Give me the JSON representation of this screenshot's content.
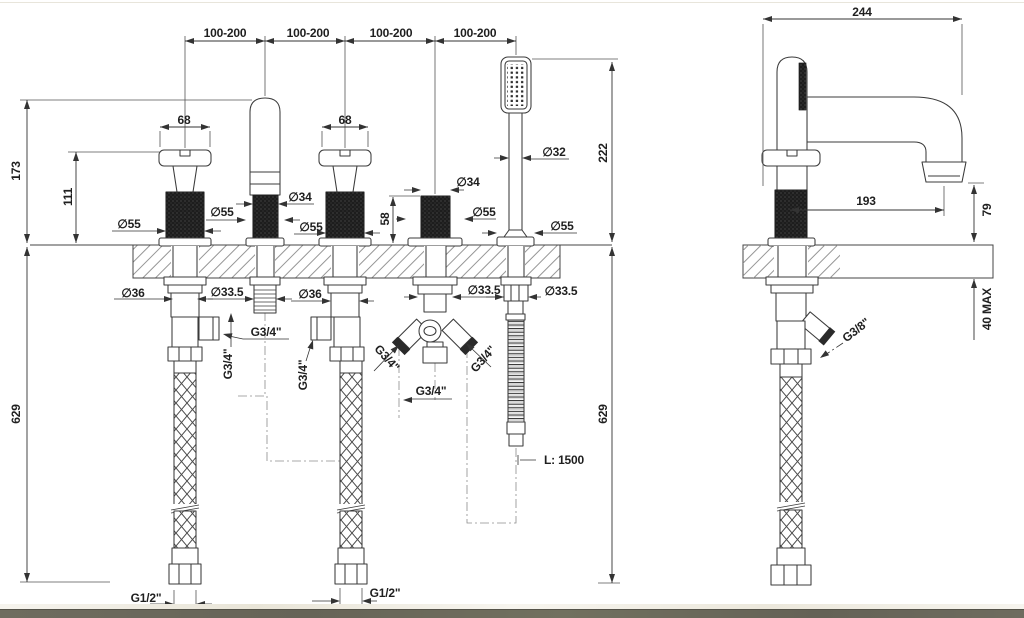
{
  "front_view": {
    "spacing_dims": [
      "100-200",
      "100-200",
      "100-200",
      "100-200"
    ],
    "handle_width_dims": [
      "68",
      "68"
    ],
    "height_dims": {
      "total": "173",
      "handle": "111",
      "knurl": "58",
      "handshower": "222"
    },
    "below_deck_dims": {
      "left": "629",
      "right": "629"
    },
    "diameter_dims": {
      "handle1_knurl": "∅55",
      "spout_knurl": "∅34",
      "spout_base": "∅55",
      "handle2_knurl": "∅55",
      "diverter_knurl": "∅34",
      "diverter_base": "∅55",
      "shower_body": "∅32",
      "shower_base": "∅55",
      "handle1_shank": "∅36",
      "spout_shank": "∅33.5",
      "handle2_shank": "∅36",
      "diverter_shank": "∅33.5",
      "shower_shank": "∅33.5"
    },
    "thread_dims": {
      "handle1_outlet": "G3/4\"",
      "spout_inlet": "G3/4\"",
      "handle2_outlet": "G3/4\"",
      "diverter_left": "G3/4\"",
      "diverter_right": "G3/4\"",
      "diverter_center": "G3/4\"",
      "supply_left": "G1/2\"",
      "supply_right": "G1/2\""
    },
    "hose_length_label": "L: 1500"
  },
  "side_view": {
    "reach": "244",
    "projection": "193",
    "outlet_height": "79",
    "max_thickness": "40 MAX",
    "supply_thread": "G3/8\""
  }
}
